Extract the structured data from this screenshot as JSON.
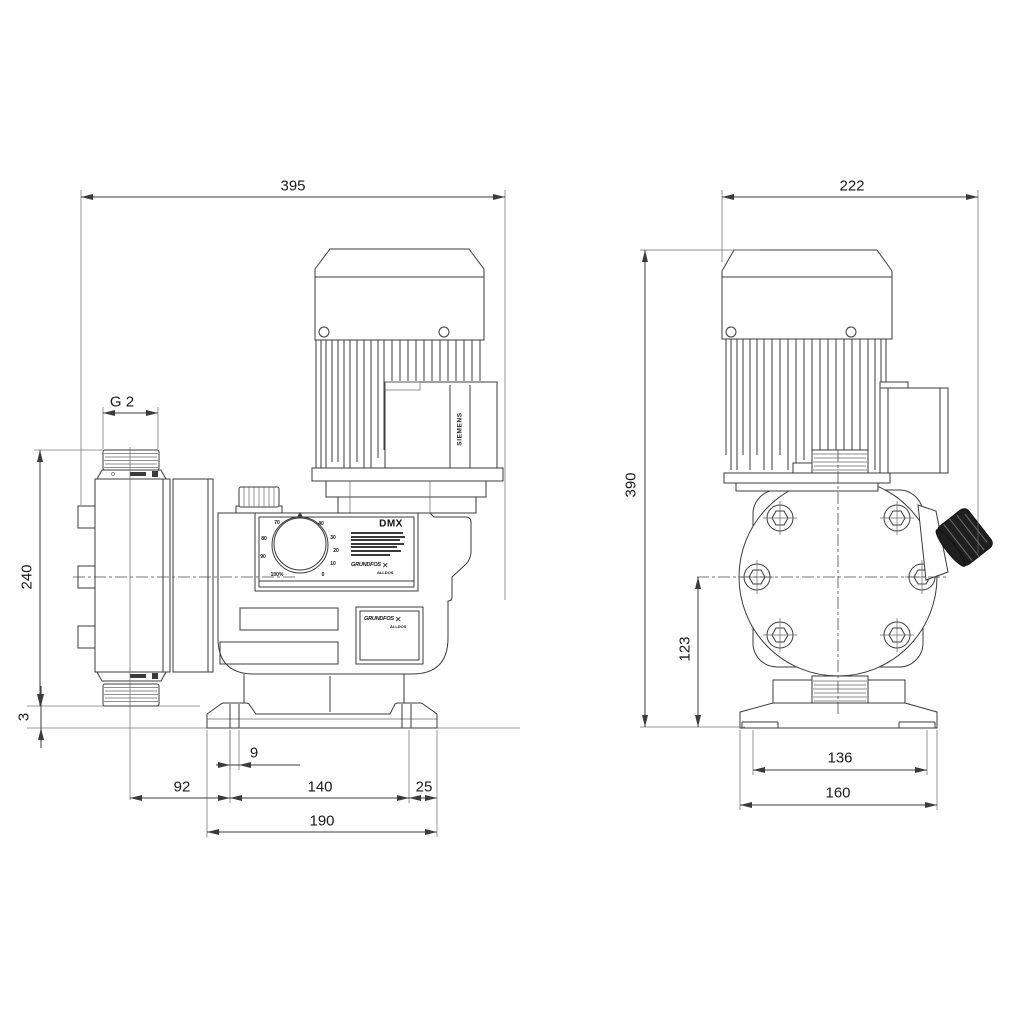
{
  "side_view": {
    "overall_width": "395",
    "thread_size": "G 2",
    "head_height": "240",
    "base_gap": "3",
    "slot_width": "9",
    "head_offset": "92",
    "foot_spacing": "140",
    "edge_offset": "25",
    "base_width": "190"
  },
  "front_view": {
    "overall_width": "222",
    "overall_height": "390",
    "center_height": "123",
    "slot_spacing": "136",
    "base_width": "160"
  },
  "branding": {
    "model": "DMX",
    "motor": "SIEMENS",
    "logo_main": "GRUNDFOS",
    "logo_sub": "ALLDOS",
    "logo_mark": "✕"
  },
  "dial": {
    "p70": "70",
    "p80": "80",
    "p90": "90",
    "p100": "100%",
    "p40": "40",
    "p30": "30",
    "p20": "20",
    "p10": "10",
    "p0": "0"
  }
}
